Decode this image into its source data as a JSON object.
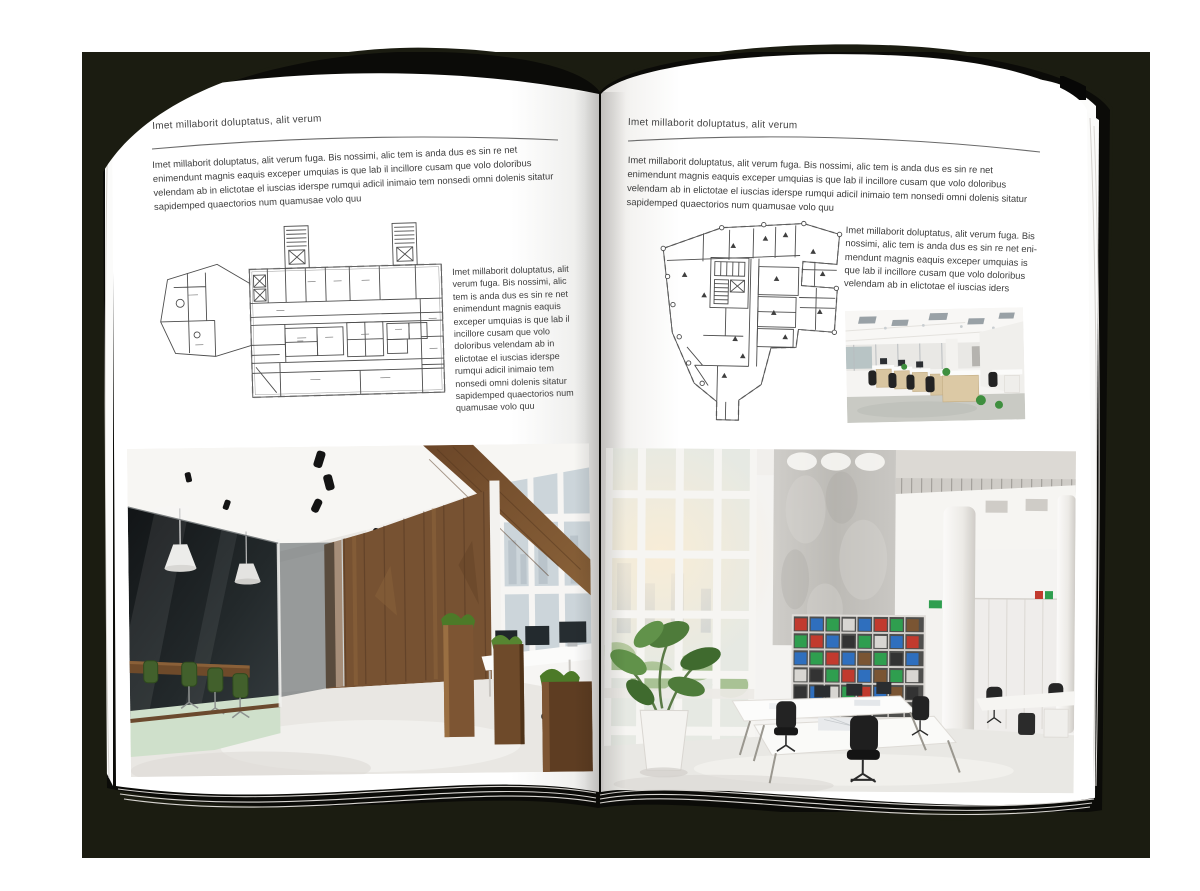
{
  "colors": {
    "backdrop": "#1b1c11",
    "cover": "#0b0b08",
    "page": "#ffffff",
    "text": "#3d3d3d",
    "rule": "#6a6a6a",
    "plan_line": "#4d4d4d",
    "wood": "#775232",
    "wood_dark": "#54351d",
    "meeting_glass": "#1c2022",
    "chair_green": "#42602c",
    "mint_floor": "#cfe0cb",
    "concrete": "#c5c3bf",
    "binder_red": "#c13a2e",
    "binder_blue": "#2f6fbe",
    "binder_green": "#2f9e4f",
    "plant_green": "#4e7b3a",
    "sun_glow": "#f6e8cf"
  },
  "spread": {
    "left": {
      "header": "Imet millaborit doluptatus, alit verum",
      "intro": "Imet millaborit doluptatus, alit verum fuga. Bis nossimi, alic tem is anda dus es sin re net enimendunt magnis eaquis exceper umquias is que lab il incillore cusam que volo doloribus velendam ab in elictotae el iuscias iderspe rumqui adicil inimaio tem nonsedi omni dolenis sitatur sapidemped quaectorios num quamusae volo quu",
      "side_text": "Imet millaborit doluptatus, alit verum fuga. Bis nossimi, alic tem is anda dus es sin re net enimendunt magnis eaquis exceper umquias is que lab il incillore cusam que volo doloribus velendam ab in elictotae el iuscias iderspe rumqui adicil inimaio tem nonsedi omni dolenis sitatur sapidemped quaectorios num quamusae volo quu",
      "floor_plan_alt": "technical floor plan, wide building with two stair towers",
      "photo_alt": "loft office with dark glass meeting room, green chairs, wooden plank wall and workstations"
    },
    "right": {
      "header": "Imet millaborit doluptatus, alit verum",
      "intro": "Imet millaborit doluptatus, alit verum fuga. Bis nossimi, alic tem is anda dus es sin re net enimendunt magnis eaquis exceper umquias is que lab il incillore cusam que volo doloribus velendam ab in elictotae el iuscias iderspe rumqui adicil inimaio tem nonsedi omni dolenis sitatur sapidemped quaectorios num quamusae volo quu",
      "side_text": "Imet millaborit doluptatus, alit verum fuga. Bis nossimi, alic tem is anda dus es sin re net eni-mendunt magnis eaquis exceper umquias is que lab il incillore cusam que volo doloribus velendam ab in elictotae el iuscias iders",
      "floor_plan_alt": "technical floor plan, irregular footprint with stair core",
      "photo_small_alt": "open office rows of workstations with light wood cabinets",
      "photo_alt": "bright double-height office, window wall, concrete panel, shelving with colored binders"
    }
  }
}
